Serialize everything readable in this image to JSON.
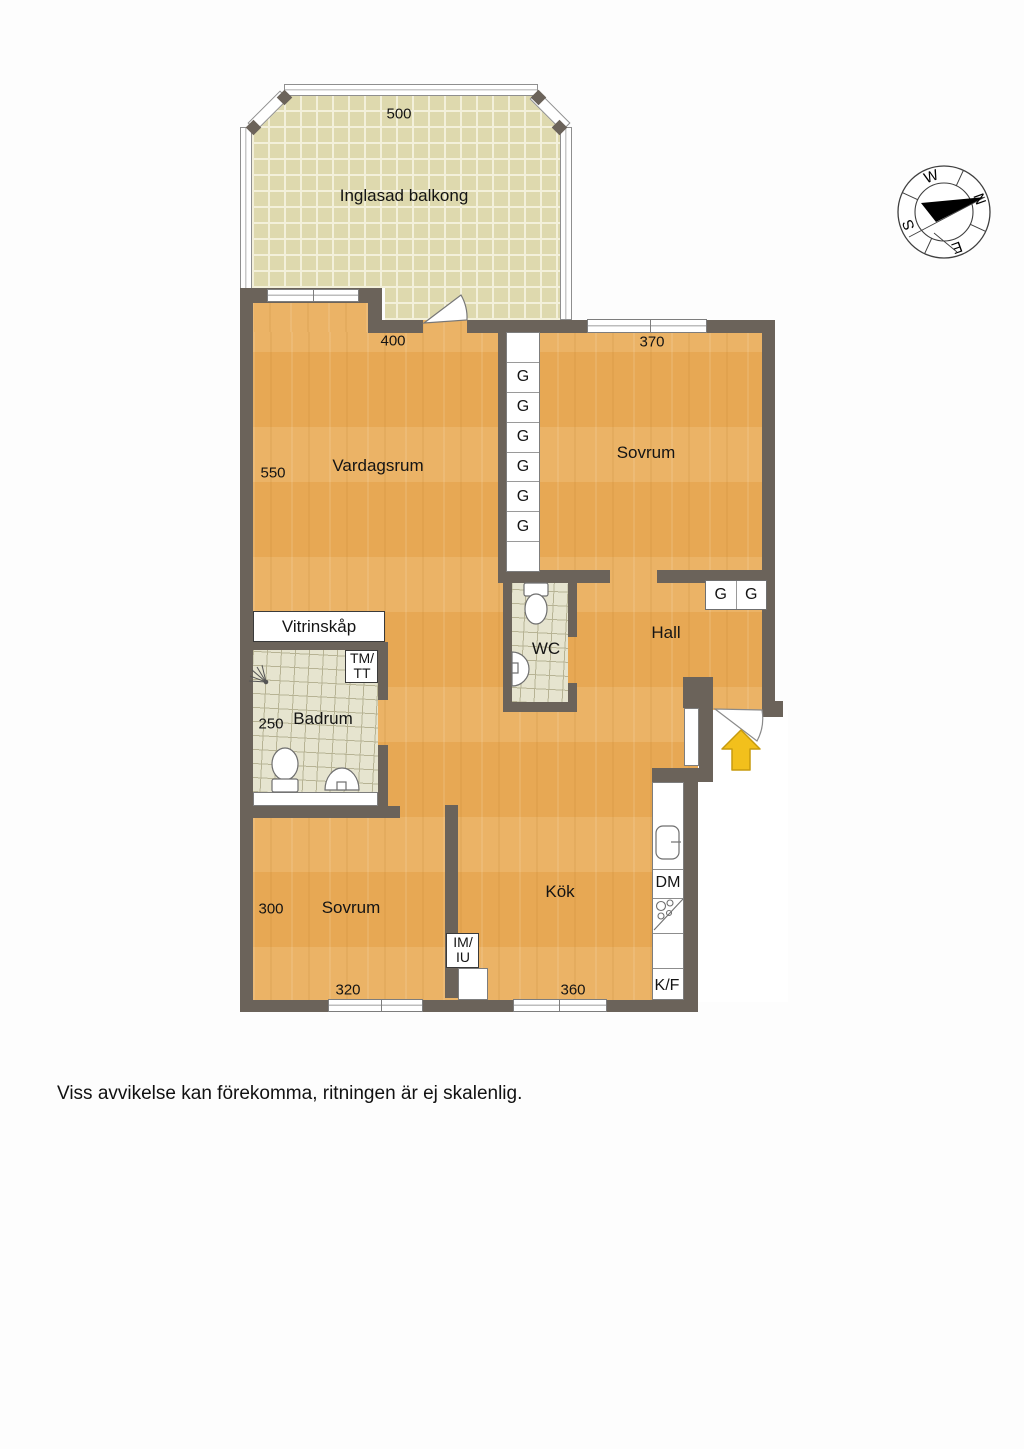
{
  "disclaimer": "Viss avvikelse kan förekomma, ritningen är ej skalenlig.",
  "balcony": {
    "label": "Inglasad balkong",
    "dim": "500"
  },
  "rooms": {
    "vardagsrum": {
      "label": "Vardagsrum",
      "width": "400",
      "depth": "550"
    },
    "sovrum_top": {
      "label": "Sovrum",
      "width": "370"
    },
    "wc": {
      "label": "WC"
    },
    "hall": {
      "label": "Hall"
    },
    "badrum": {
      "label": "Badrum",
      "depth": "250"
    },
    "sovrum_bottom": {
      "label": "Sovrum",
      "depth": "300",
      "width": "320"
    },
    "kok": {
      "label": "Kök",
      "width": "360"
    }
  },
  "cabinets": {
    "vitrinskap": "Vitrinskåp",
    "wardrobe": "G",
    "tm_tt": [
      "TM/",
      "TT"
    ],
    "im_iu": [
      "IM/",
      "IU"
    ],
    "dm": "DM",
    "kf": "K/F"
  },
  "compass": {
    "n": "N",
    "e": "E",
    "s": "S",
    "w": "W"
  },
  "colors": {
    "floor": "#e7a854",
    "wall": "#6b635a",
    "balcony_tile": "#ded9ae",
    "bath_tile": "#e6e4cf",
    "entry_arrow": "#f2c01c"
  }
}
